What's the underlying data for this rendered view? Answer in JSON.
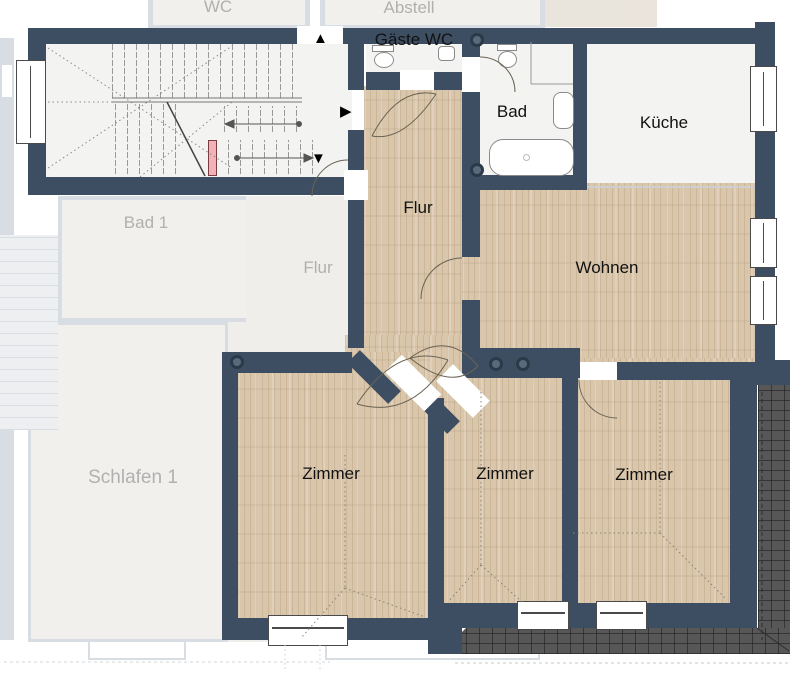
{
  "plan_title": "Wohnungsgrundriss",
  "rooms": [
    {
      "label": "Gäste WC"
    },
    {
      "label": "Bad"
    },
    {
      "label": "Küche"
    },
    {
      "label": "Flur"
    },
    {
      "label": "Wohnen"
    },
    {
      "label": "Zimmer"
    },
    {
      "label": "Zimmer"
    },
    {
      "label": "Zimmer"
    }
  ],
  "faded_rooms": [
    {
      "label": "WC"
    },
    {
      "label": "Abstell"
    },
    {
      "label": "Bad 1"
    },
    {
      "label": "Flur"
    },
    {
      "label": "Schlafen 1"
    }
  ],
  "icons": {
    "arrow_up": "▲",
    "arrow_right": "▶",
    "arrow_down": "▼"
  },
  "colors": {
    "wall": "#3e4e62",
    "wood_floor": "#d9c6ab",
    "light_floor": "#f3f3f1",
    "terrace_tiles": "#575757",
    "stair_marker_pink": "#f2b3b8",
    "faded_wall": "#b9c2cd"
  }
}
